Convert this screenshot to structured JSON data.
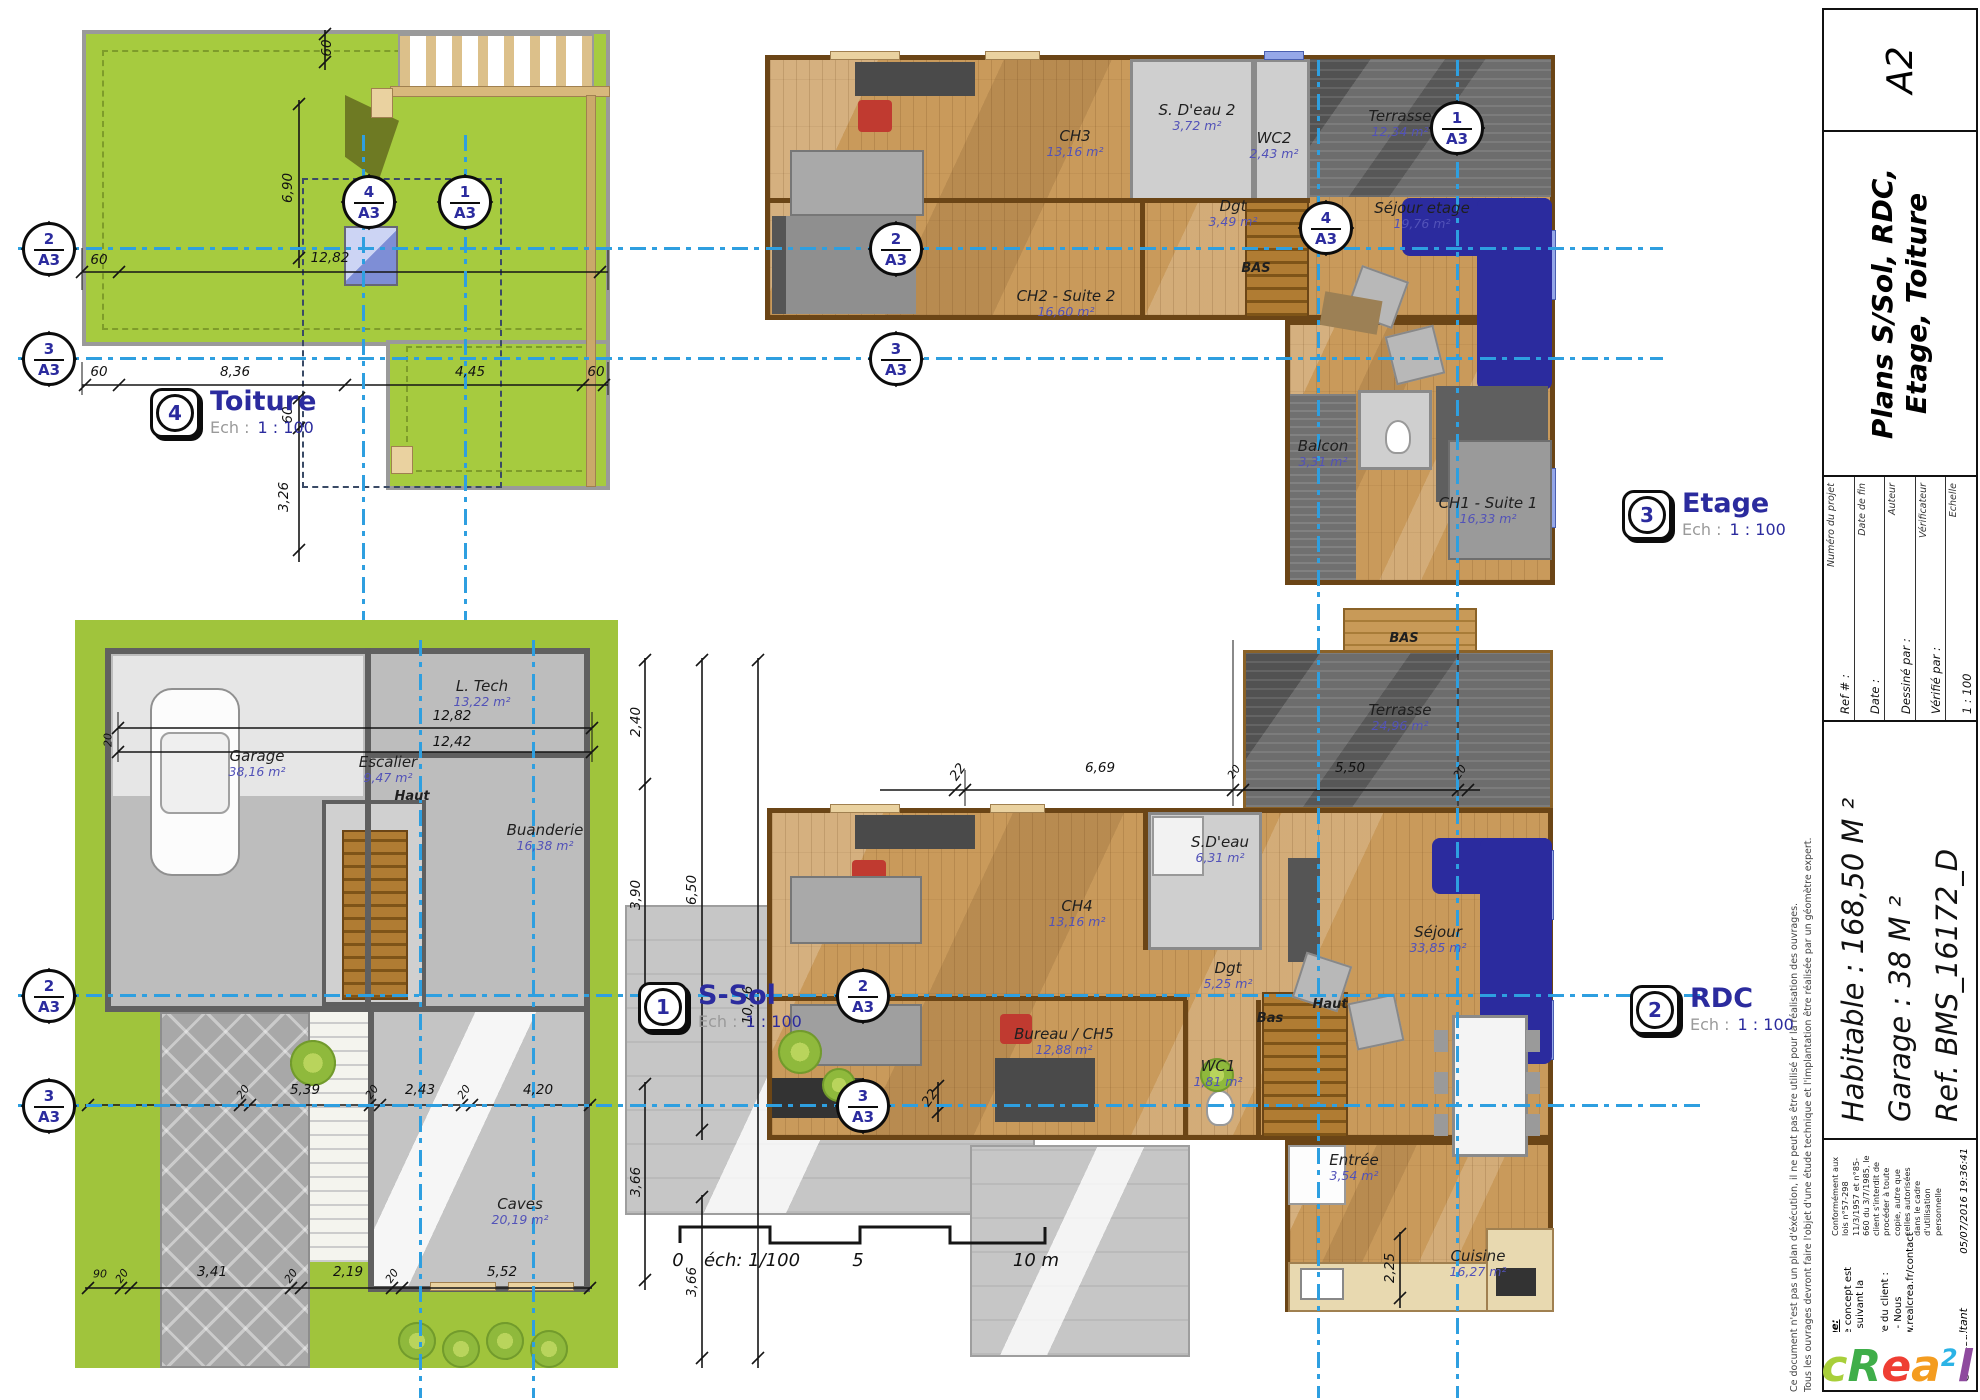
{
  "colors": {
    "section_line": "#2e9fe0",
    "roof_green": "#a6cb3f",
    "wood_floor": "#c99a5b",
    "terrace_gray": "#6d6d6d",
    "accent_blue_text": "#2b2b9e",
    "area_text": "#5252b8",
    "furniture_blue": "#2b2b9e",
    "accent_red": "#c03a30"
  },
  "sec": {
    "s1": "1",
    "s2": "2",
    "s3": "3",
    "s4": "4",
    "ref": "A3"
  },
  "plans": {
    "toiture": {
      "icon_num": "4",
      "title": "Toiture",
      "scale_prefix": "Ech :",
      "scale_value": "1 : 100",
      "dims": {
        "v60top": "60",
        "h1282": "12,82",
        "h60a": "60",
        "v690": "6,90",
        "h60b": "60",
        "h836": "8,36",
        "h445": "4,45",
        "h60c": "60",
        "v60mid": "60",
        "v326": "3,26"
      }
    },
    "etage": {
      "icon_num": "3",
      "title": "Etage",
      "scale_prefix": "Ech :",
      "scale_value": "1 : 100",
      "rooms": [
        {
          "name": "CH3",
          "area": "13,16 m²"
        },
        {
          "name": "S. D'eau 2",
          "area": "3,72 m²"
        },
        {
          "name": "WC2",
          "area": "2,43 m²"
        },
        {
          "name": "Terrasse",
          "area": "12,34 m²"
        },
        {
          "name": "Dgt",
          "area": "3,49 m²"
        },
        {
          "name": "Séjour etage",
          "area": "19,76 m²"
        },
        {
          "name": "CH2 - Suite 2",
          "area": "16,60 m²"
        },
        {
          "name": "BAS",
          "area": ""
        },
        {
          "name": "Balcon",
          "area": "3,31 m²"
        },
        {
          "name": "CH1 - Suite 1",
          "area": "16,33 m²"
        }
      ]
    },
    "rdc": {
      "icon_num": "2",
      "title": "RDC",
      "scale_prefix": "Ech :",
      "scale_value": "1 : 100",
      "rooms": [
        {
          "name": "BAS",
          "area": ""
        },
        {
          "name": "Terrasse",
          "area": "24,96 m²"
        },
        {
          "name": "CH4",
          "area": "13,16 m²"
        },
        {
          "name": "S.D'eau",
          "area": "6,31 m²"
        },
        {
          "name": "Séjour",
          "area": "33,85 m²"
        },
        {
          "name": "Dgt",
          "area": "5,25 m²"
        },
        {
          "name": "Bureau / CH5",
          "area": "12,88 m²"
        },
        {
          "name": "WC1",
          "area": "1,81 m²"
        },
        {
          "name": "Bas",
          "area": ""
        },
        {
          "name": "Haut",
          "area": ""
        },
        {
          "name": "Entrée",
          "area": "3,54 m²"
        },
        {
          "name": "Cuisine",
          "area": "16,27 m²"
        }
      ],
      "dims": {
        "t22": "22",
        "t669": "6,69",
        "t20a": "20",
        "t550": "5,50",
        "t20b": "20",
        "l22": "22",
        "v225": "2,25"
      }
    },
    "ssol": {
      "icon_num": "1",
      "title": "S-Sol",
      "scale_prefix": "Ech :",
      "scale_value": "1 : 100",
      "rooms": [
        {
          "name": "Garage",
          "area": "38,16 m²"
        },
        {
          "name": "L. Tech",
          "area": "13,22 m²"
        },
        {
          "name": "Escalier",
          "area": "9,47 m²"
        },
        {
          "name": "Haut",
          "area": ""
        },
        {
          "name": "Buanderie",
          "area": "16,38 m²"
        },
        {
          "name": "Caves",
          "area": "20,19 m²"
        }
      ],
      "dims": {
        "t1282": "12,82",
        "t1242": "12,42",
        "l20": "20",
        "m20a": "20",
        "m539": "5,39",
        "m20b": "20",
        "m243": "2,43",
        "m20c": "20",
        "m420": "4,20",
        "b90": "90",
        "b20a": "20",
        "b341": "3,41",
        "b20b": "20",
        "b219": "2,19",
        "b20c": "20",
        "b552": "5,52",
        "r240": "2,40",
        "r390": "3,90",
        "r366": "3,66",
        "o650": "6,50",
        "o366": "3,66",
        "o1076": "10,76"
      }
    }
  },
  "scale_bar": {
    "zero": "0",
    "label": "éch: 1/100",
    "mid": "5",
    "end": "10 m"
  },
  "title_block": {
    "title": "Plans S/Sol, RDC, Etage, Toiture",
    "sheet_size": "A2",
    "fields": [
      {
        "caption": "Numéro du projet",
        "value": "Ref # :"
      },
      {
        "caption": "Date de fin",
        "value": "Date :"
      },
      {
        "caption": "Auteur",
        "value": "Dessiné par :"
      },
      {
        "caption": "Vérificateur",
        "value": "Vérifié par :"
      },
      {
        "caption": "Echelle",
        "value": "1 : 100"
      }
    ],
    "habitable": "Habitable : 168,50 M ²",
    "garage": "Garage : 38 M ²",
    "reference": "Ref. BMS_16172_D",
    "nota_title": "Nota Bene:",
    "nota_line1": "Ce plan de concept est adaptable suivant la demande",
    "nota_line2": "particulière du client :",
    "nota_line3": "Contactez - Nous http://www.realcrea.fr/contact",
    "legal": "Conformément aux lois n°57-298 11/3/1957 et n°85-660 du 3/7/1985, le client s'interdit de procéder à toute copie, autre que celles autorisées dans le cadre d'utilisation personnelle",
    "consultant": "@ Consultant",
    "datetime": "05/07/2016 19:36:41",
    "disclaimer1": "Ce document n'est pas un plan d'éxécution, il ne peut pas être utilisé pour la réalisation des ouvrages.",
    "disclaimer2": "Tous les ouvrages devront faire l'objet d'une étude technique et l'implantation être réalisée par un géomètre expert.",
    "logo": {
      "l0": "c",
      "l1": "R",
      "l2": "e",
      "l3": "a",
      "l4": "2",
      "l5": "l"
    }
  }
}
